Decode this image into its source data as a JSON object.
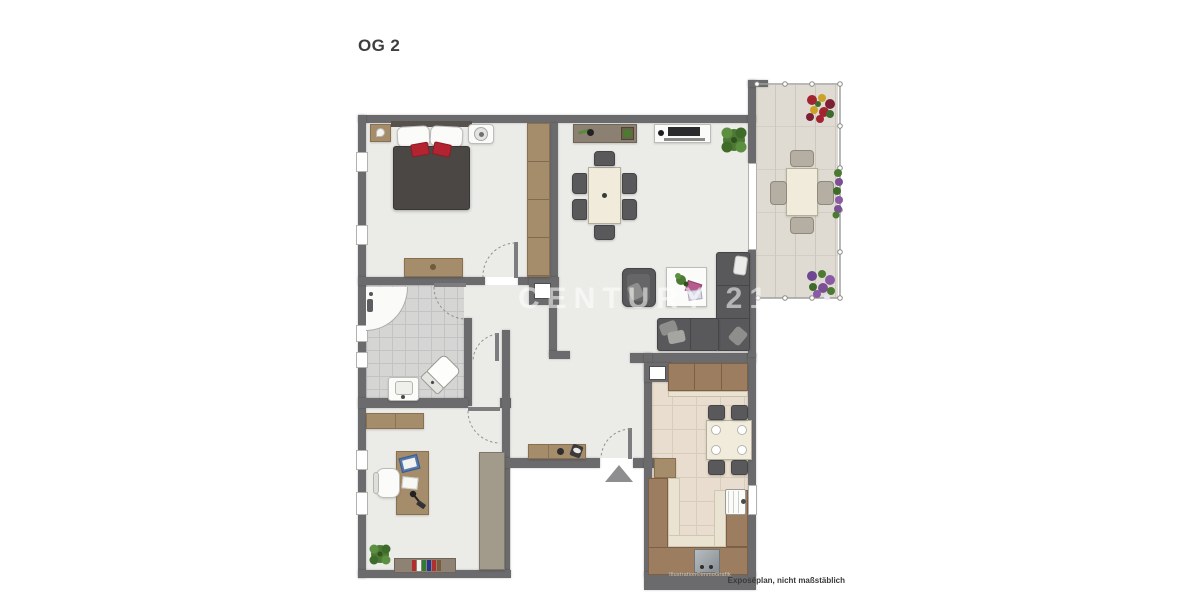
{
  "texts": {
    "title": "OG 2",
    "watermark": "CENTURY 21",
    "disclaimer": "Exposéplan, nicht maßstäblich",
    "credit": "Illustration©immoGrafik"
  },
  "colors": {
    "wall": "#6b6b6d",
    "floor": "#ebebe8",
    "bath_floor": "#d5d5d4",
    "kitchen_floor": "#e9ddcf",
    "balcony_floor": "#dfdbd2",
    "wood": "#a58c6b",
    "wood_dark": "#89714f",
    "counter": "#9c7d5f",
    "counter_edge": "#eae3d2",
    "sofa": "#59595b",
    "bed_duvet": "#4a4745",
    "accent_red": "#b32431",
    "table_cream": "#f1ebdb",
    "plant_green": "#4c7a33",
    "watermark": "#ffffff"
  },
  "rooms": [
    {
      "name": "bedroom",
      "furniture": [
        "double-bed",
        "nightstand",
        "nightstand",
        "wardrobe",
        "dresser"
      ]
    },
    {
      "name": "bathroom",
      "furniture": [
        "corner-shower",
        "washbasin",
        "toilet"
      ]
    },
    {
      "name": "hallway",
      "furniture": [
        "sideboard"
      ]
    },
    {
      "name": "study",
      "furniture": [
        "desk",
        "office-chair",
        "shelf",
        "bookshelf",
        "plant"
      ]
    },
    {
      "name": "living-dining-room",
      "furniture": [
        "sideboard",
        "tv-lowboard",
        "dining-table",
        "chairs",
        "corner-sofa",
        "armchair",
        "coffee-table",
        "plant"
      ]
    },
    {
      "name": "kitchen",
      "furniture": [
        "wall-cabinets",
        "u-counter",
        "sink",
        "stove",
        "table",
        "chairs"
      ]
    },
    {
      "name": "balcony",
      "furniture": [
        "table",
        "chairs",
        "flower-boxes"
      ]
    }
  ]
}
